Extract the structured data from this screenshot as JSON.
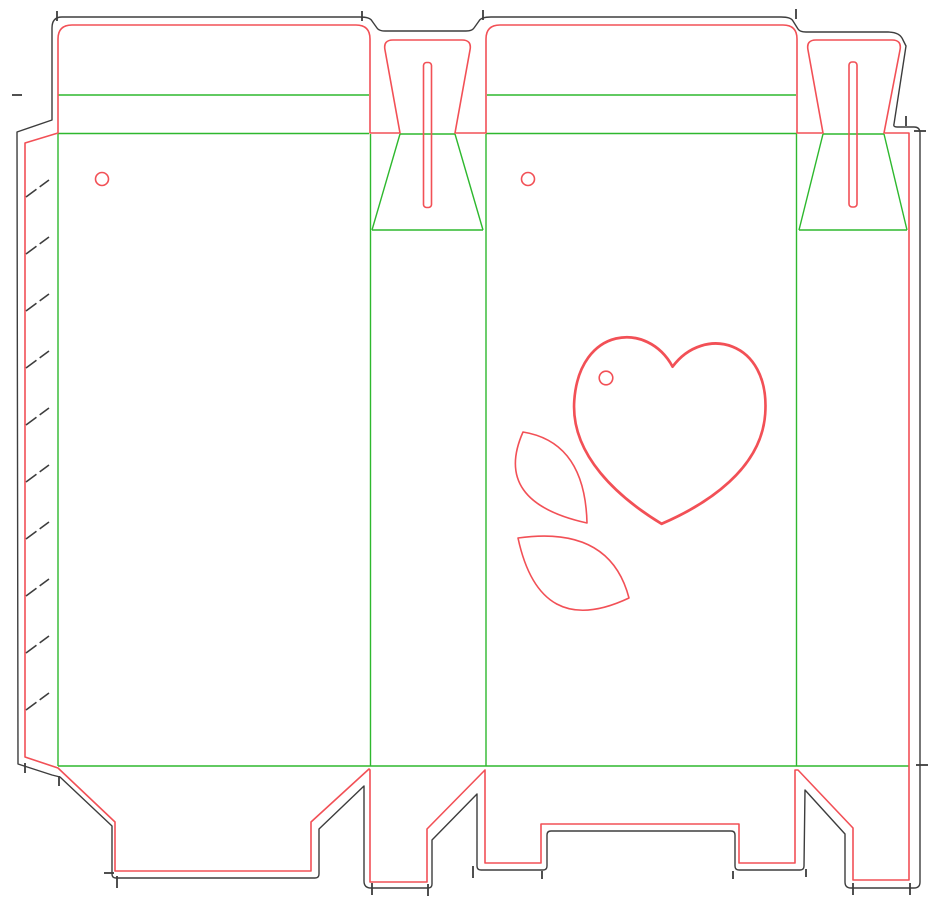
{
  "document": {
    "kind": "packaging-dieline-drawing",
    "description": "Die-cut template for a folding carton with tuck tabs, slots, glue flap and decorative heart/leaf cutouts",
    "background": "#ffffff"
  },
  "colors": {
    "cut_red": "#f25056",
    "crease_green": "#2eb82e",
    "bleed_black": "#3d3d3d"
  },
  "line_types": [
    {
      "name": "cut-line",
      "color_key": "cut_red"
    },
    {
      "name": "crease-line",
      "color_key": "crease_green"
    },
    {
      "name": "bleed-outline",
      "color_key": "bleed_black"
    }
  ],
  "dieline": {
    "panels": [
      "glue-flap",
      "front-panel",
      "side-panel-1",
      "back-panel",
      "side-panel-2"
    ],
    "top_closure": {
      "tuck_flaps": 2,
      "lock_tabs": 2,
      "lock_slots": 2
    },
    "bottom_closure": {
      "flaps": 4
    },
    "holes": 3,
    "glue_flap_hatch_marks": 10,
    "decorative_cutouts": [
      "heart",
      "leaf",
      "leaf"
    ],
    "nick_marks": 18
  }
}
